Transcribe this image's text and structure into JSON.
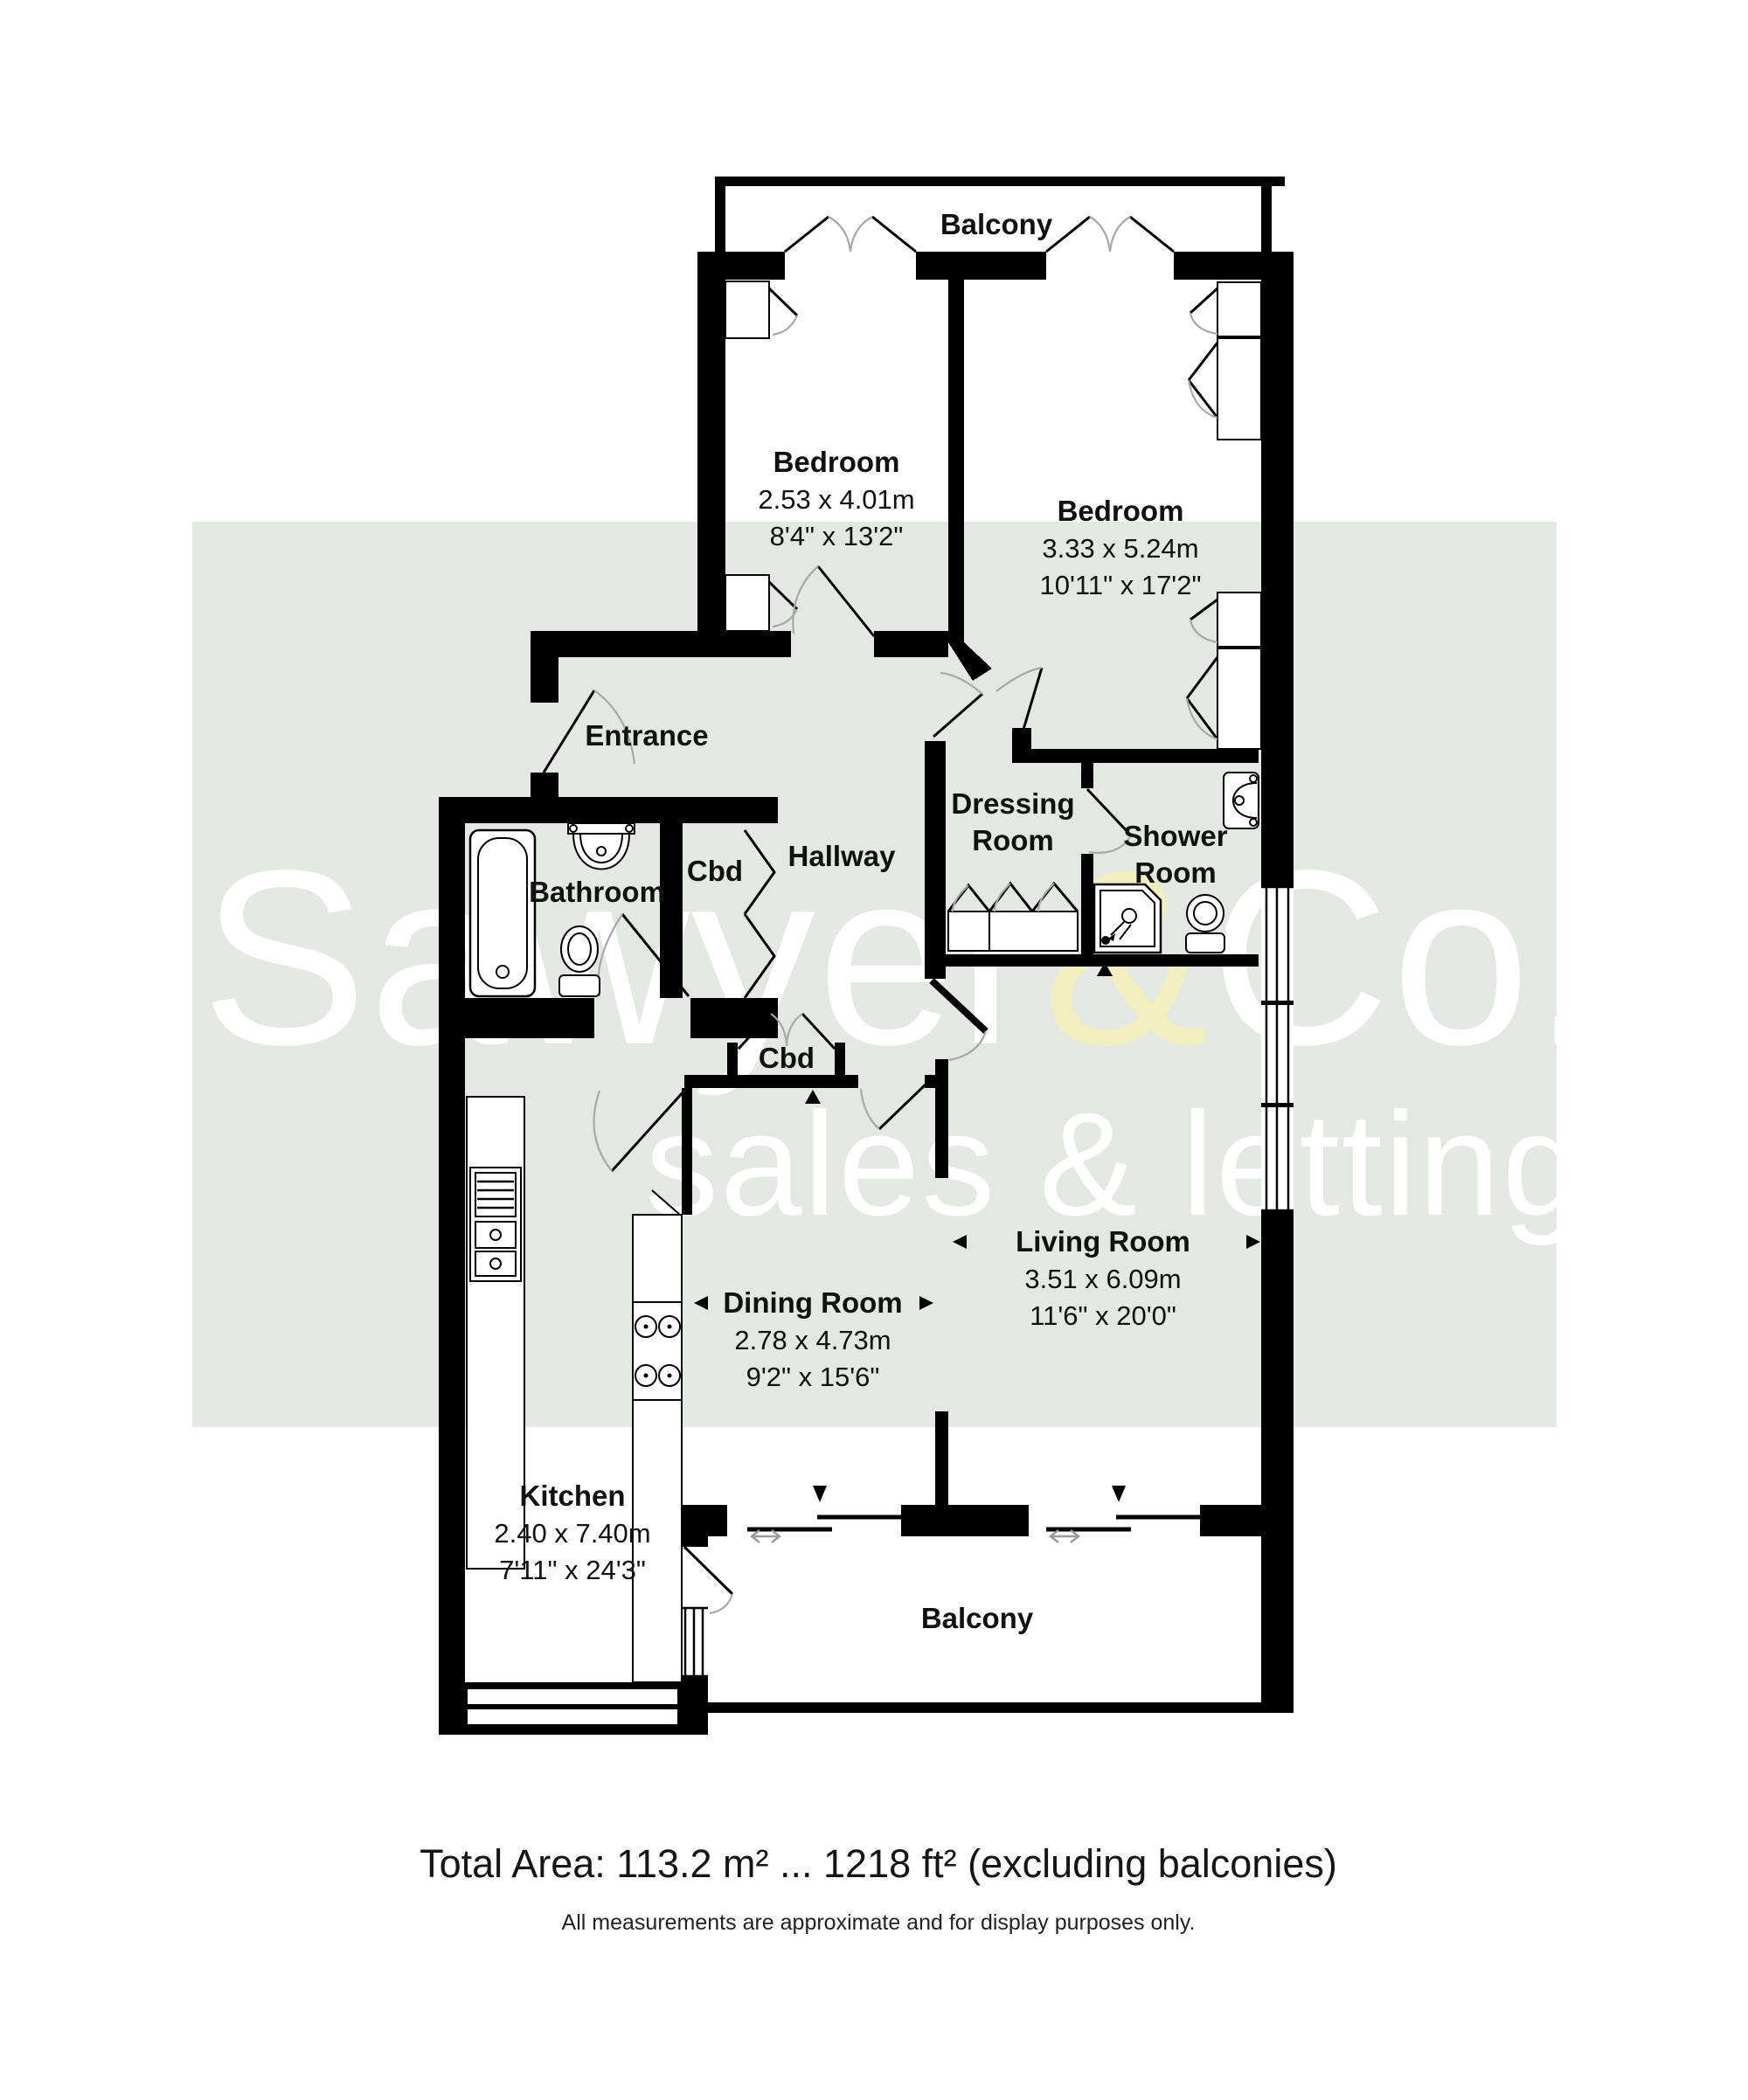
{
  "watermark": {
    "brand_part1": "Sawyer",
    "brand_amp": "&",
    "brand_part2": "Co.",
    "tagline": "sales & lettings",
    "band_color": "#e3e8e2",
    "text_color": "#ffffff",
    "amp_color": "#f2efbe"
  },
  "rooms": {
    "balcony_top": {
      "name": "Balcony"
    },
    "bedroom1": {
      "name": "Bedroom",
      "metric": "2.53 x 4.01m",
      "imperial": "8'4\" x 13'2\""
    },
    "bedroom2": {
      "name": "Bedroom",
      "metric": "3.33 x 5.24m",
      "imperial": "10'11\" x 17'2\""
    },
    "entrance": {
      "name": "Entrance"
    },
    "hallway": {
      "name": "Hallway"
    },
    "bathroom": {
      "name": "Bathroom"
    },
    "cbd1": {
      "name": "Cbd"
    },
    "cbd2": {
      "name": "Cbd"
    },
    "dressing": {
      "line1": "Dressing",
      "line2": "Room"
    },
    "shower": {
      "line1": "Shower",
      "line2": "Room"
    },
    "living": {
      "name": "Living Room",
      "metric": "3.51 x 6.09m",
      "imperial": "11'6\" x 20'0\""
    },
    "dining": {
      "name": "Dining Room",
      "metric": "2.78 x 4.73m",
      "imperial": "9'2\" x 15'6\""
    },
    "kitchen": {
      "name": "Kitchen",
      "metric": "2.40 x 7.40m",
      "imperial": "7'11\" x 24'3\""
    },
    "balcony_bottom": {
      "name": "Balcony"
    }
  },
  "footer": {
    "total_area": "Total Area: 113.2 m² ... 1218 ft² (excluding balconies)",
    "disclaimer": "All measurements are approximate and for display purposes only."
  }
}
